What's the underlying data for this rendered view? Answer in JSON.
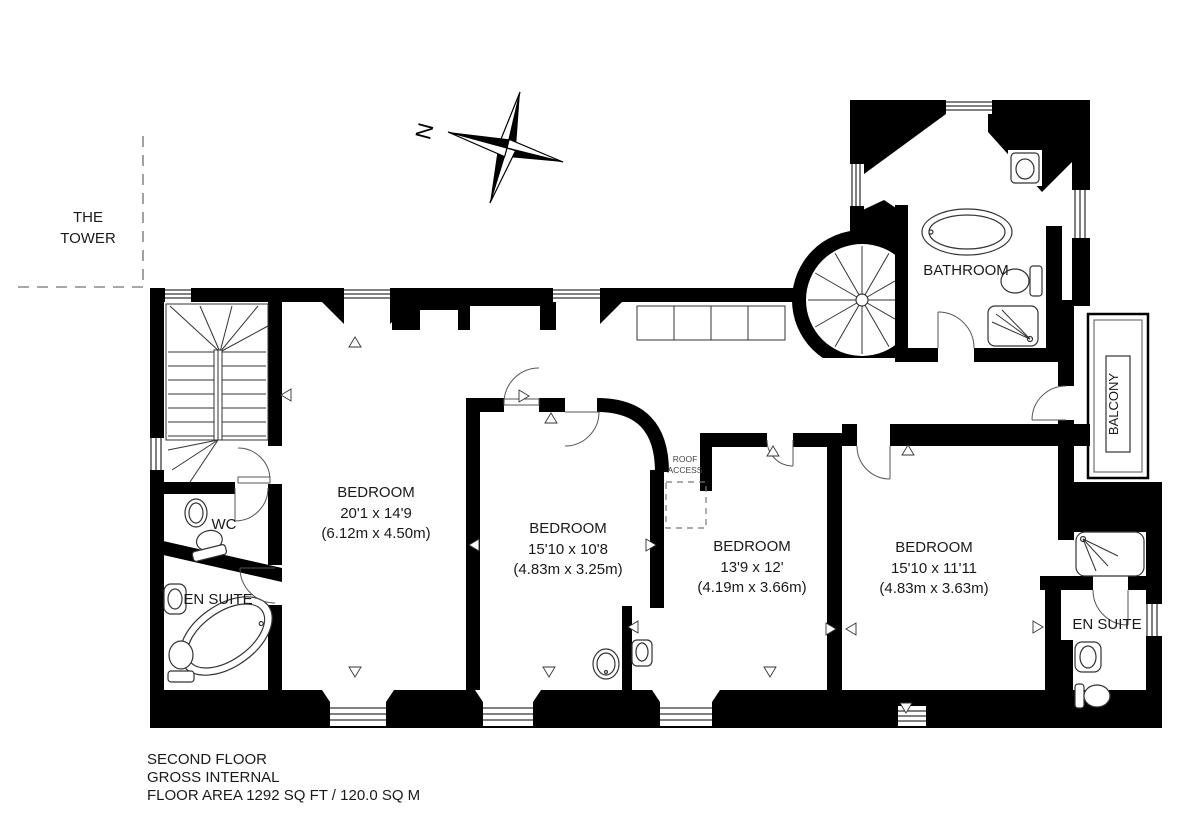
{
  "plan": {
    "footer": {
      "line1": "SECOND FLOOR",
      "line2": "GROSS INTERNAL",
      "line3": "FLOOR AREA 1292 SQ FT / 120.0 SQ M"
    },
    "compass_north": "N",
    "tower": {
      "line1": "THE",
      "line2": "TOWER"
    },
    "balcony_label": "BALCONY",
    "roof_access": {
      "line1": "ROOF",
      "line2": "ACCESS"
    },
    "rooms": {
      "bedroom_1": {
        "name": "BEDROOM",
        "size_imperial": "20'1 x 14'9",
        "size_metric": "(6.12m x 4.50m)"
      },
      "bedroom_2": {
        "name": "BEDROOM",
        "size_imperial": "15'10 x 10'8",
        "size_metric": "(4.83m x 3.25m)"
      },
      "bedroom_3": {
        "name": "BEDROOM",
        "size_imperial": "13'9 x 12'",
        "size_metric": "(4.19m x 3.66m)"
      },
      "bedroom_4": {
        "name": "BEDROOM",
        "size_imperial": "15'10 x 11'11",
        "size_metric": "(4.83m x 3.63m)"
      },
      "bathroom": {
        "name": "BATHROOM"
      },
      "wc": {
        "name": "WC"
      },
      "en_suite_left": {
        "name": "EN SUITE"
      },
      "en_suite_right": {
        "name": "EN SUITE"
      }
    },
    "colors": {
      "wall": "#000000",
      "background": "#ffffff",
      "dashed_line": "#8a8a8a"
    }
  }
}
